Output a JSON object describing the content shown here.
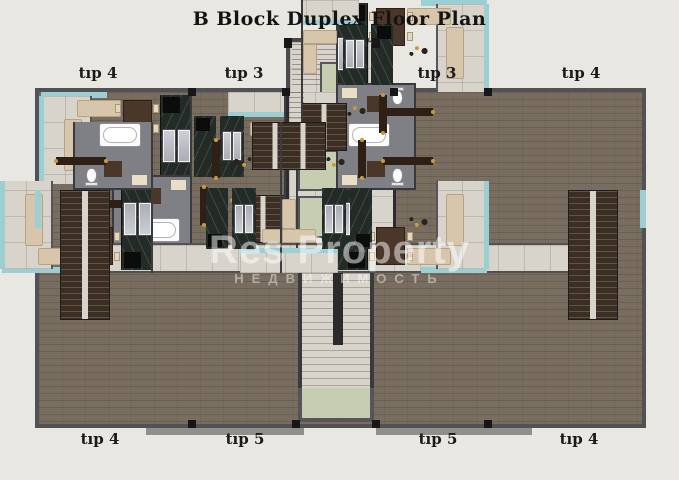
{
  "title": "B Block Duplex Floor Plan",
  "plan": {
    "top_labels": [
      "tıp 4",
      "tıp 3",
      "tıp 3",
      "tıp 4"
    ],
    "bottom_labels": [
      "tıp 4",
      "tıp 5",
      "tıp 5",
      "tıp 4"
    ],
    "watermark": "Res Property",
    "watermark_sub": "НЕДВИЖИМОСТЬ",
    "colors": {
      "background": "#e9e7e2",
      "wall": "#515156",
      "wood": "#796d60",
      "wood_dark": "#3c2e22",
      "tile": "#d8d4cb",
      "teal": "#9ccfd4",
      "sage": "#c6cdb0",
      "bath": "#7f8086",
      "marble": "#232b26",
      "sofa": "#d8c6ac"
    }
  }
}
